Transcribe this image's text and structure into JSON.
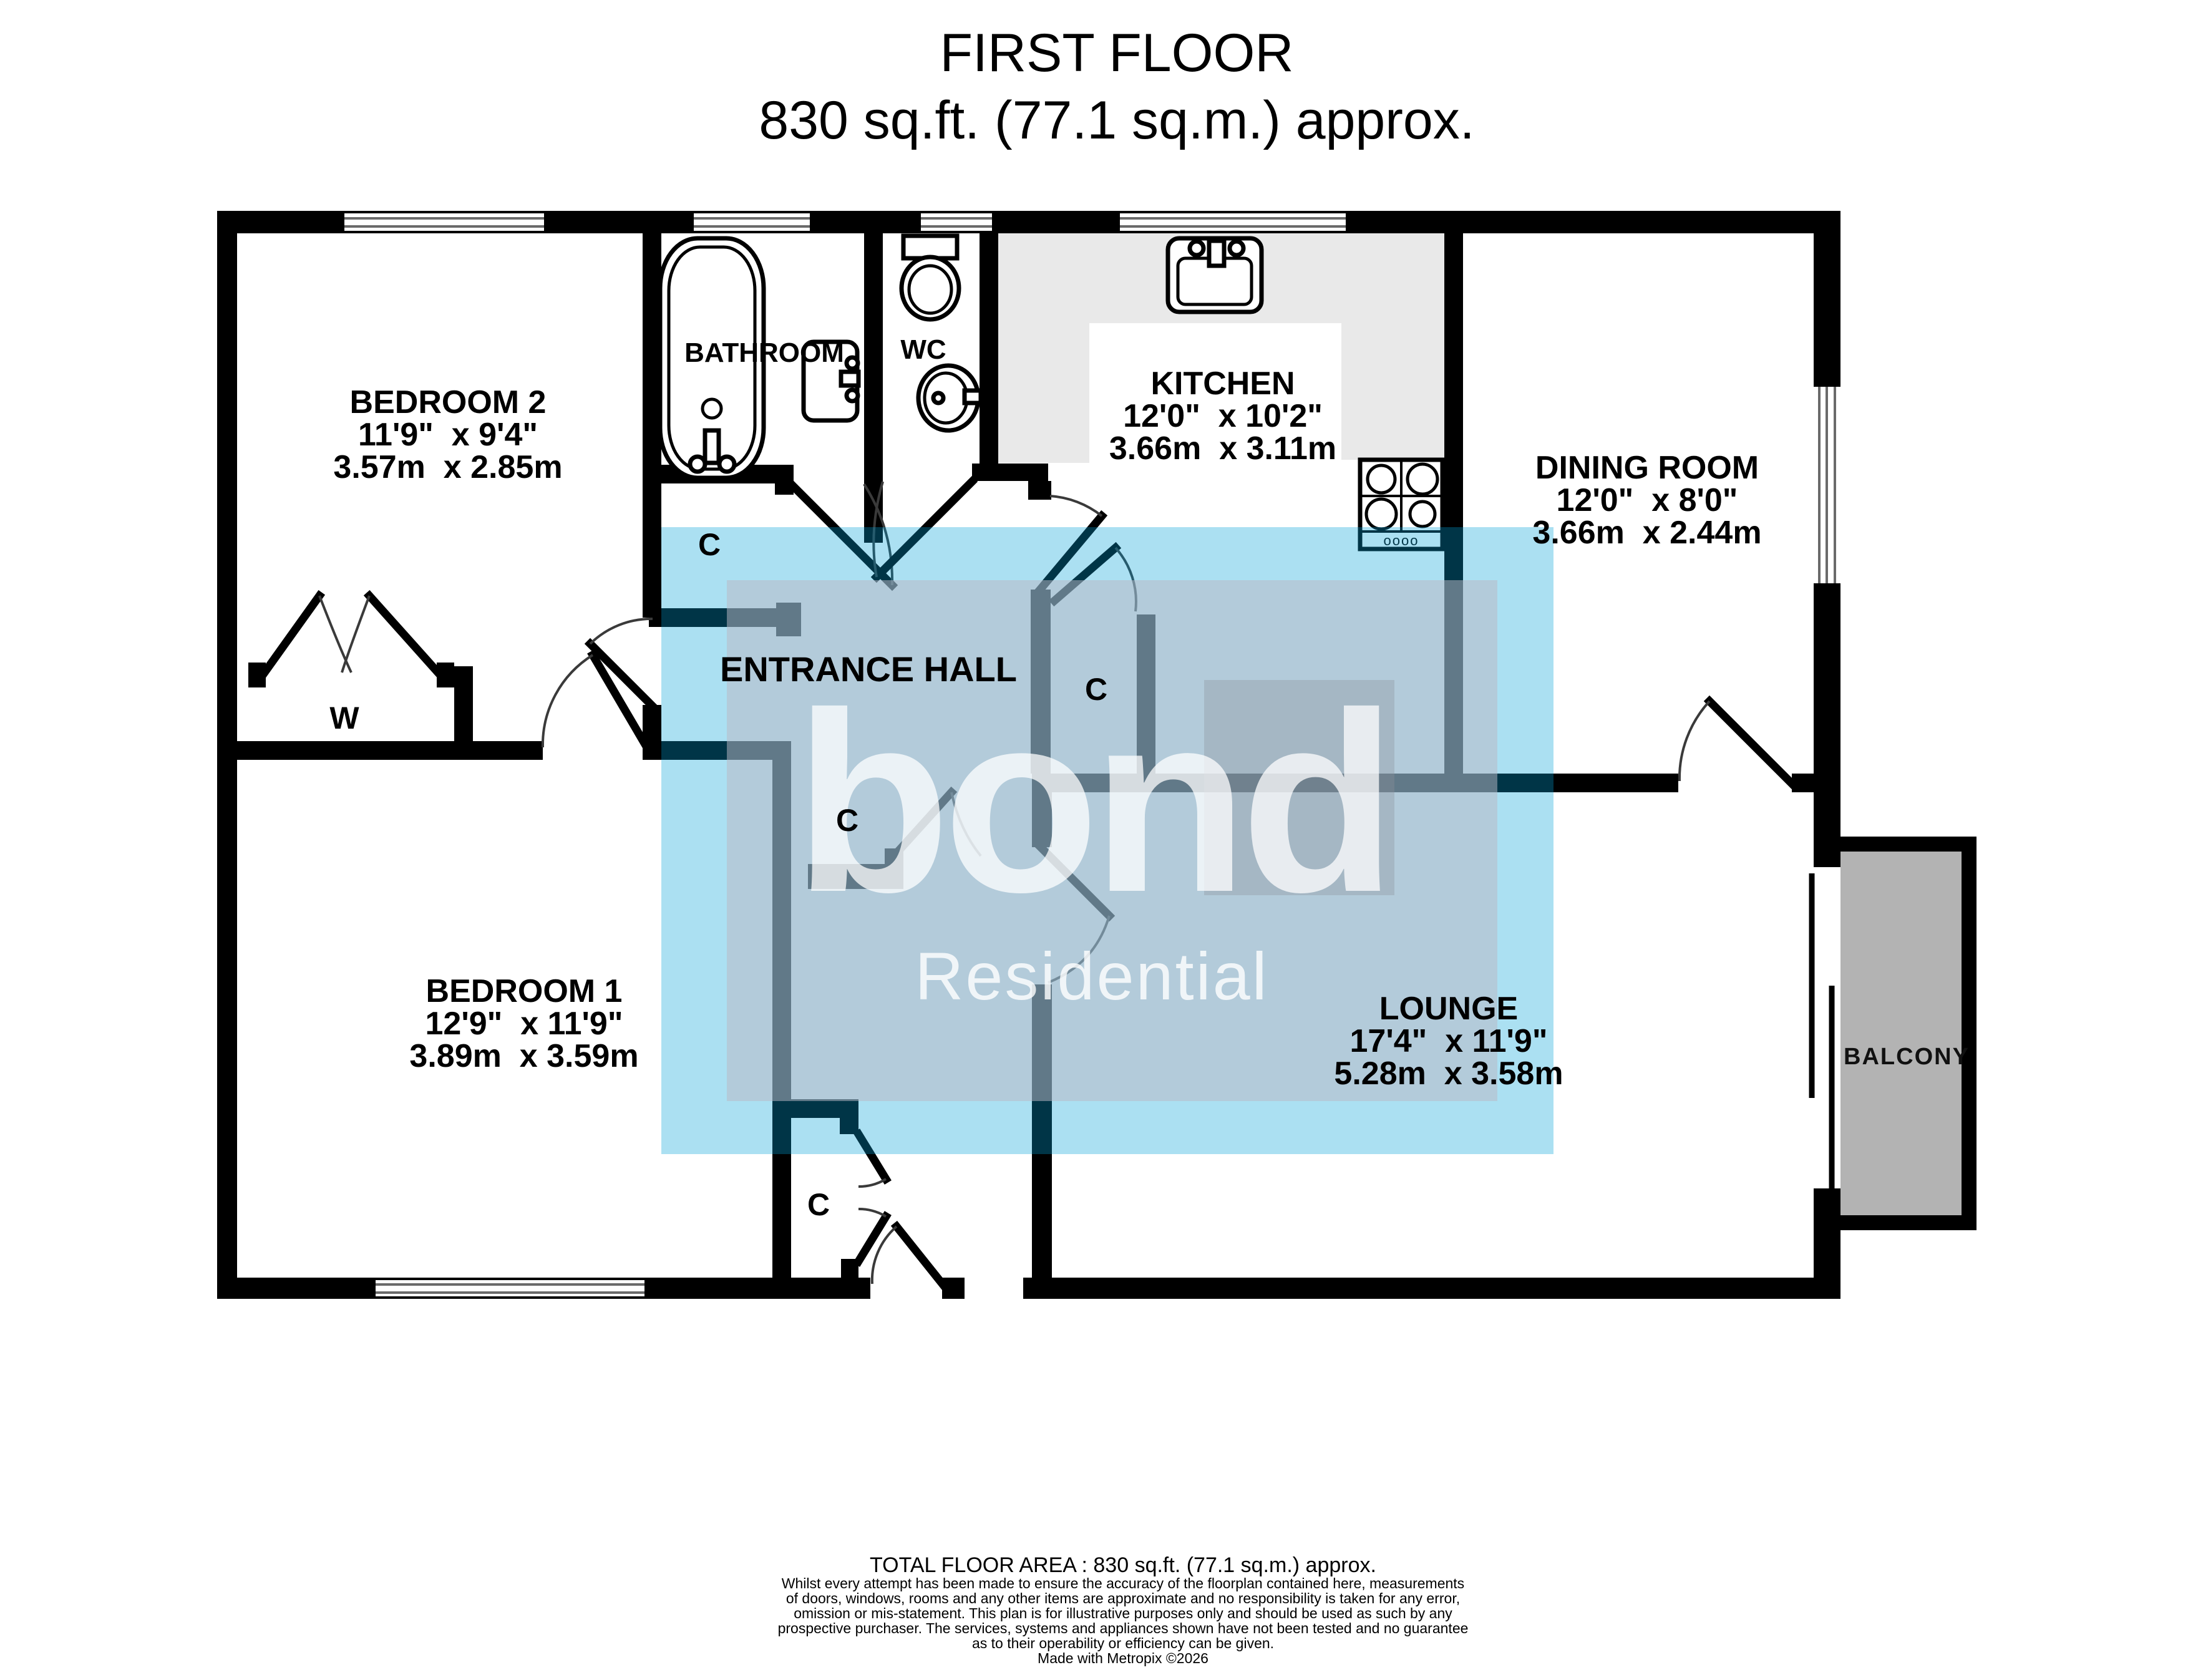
{
  "title": {
    "line1": "FIRST FLOOR",
    "line2": "830 sq.ft. (77.1 sq.m.) approx."
  },
  "watermark": {
    "brand": "bond",
    "subtitle": "Residential"
  },
  "rooms": {
    "bedroom2": {
      "name": "BEDROOM 2",
      "imperial": "11'9\"  x 9'4\"",
      "metric": "3.57m  x 2.85m"
    },
    "bathroom": {
      "name": "BATHROOM"
    },
    "wc": {
      "name": "WC"
    },
    "kitchen": {
      "name": "KITCHEN",
      "imperial": "12'0\"  x 10'2\"",
      "metric": "3.66m  x 3.11m"
    },
    "dining": {
      "name": "DINING ROOM",
      "imperial": "12'0\"  x 8'0\"",
      "metric": "3.66m  x 2.44m"
    },
    "hall": {
      "name": "ENTRANCE HALL"
    },
    "bedroom1": {
      "name": "BEDROOM 1",
      "imperial": "12'9\"  x 11'9\"",
      "metric": "3.89m  x 3.59m"
    },
    "lounge": {
      "name": "LOUNGE",
      "imperial": "17'4\"  x 11'9\"",
      "metric": "5.28m  x 3.58m"
    },
    "balcony": {
      "name": "BALCONY"
    }
  },
  "labels": {
    "closet": "C",
    "wardrobe": "W",
    "hob_knobs": "oooo"
  },
  "footer": {
    "total": "TOTAL FLOOR AREA : 830 sq.ft. (77.1 sq.m.) approx.",
    "disclaimer": [
      "Whilst every attempt has been made to ensure the accuracy of the floorplan contained here, measurements",
      "of doors, windows, rooms and any other items are approximate and no responsibility is taken for any error,",
      "omission or mis-statement. This plan is for illustrative purposes only and should be used as such by any",
      "prospective purchaser. The services, systems and appliances shown have not been tested and no guarantee",
      "as to their operability or efficiency can be given."
    ],
    "credit": "Made with Metropix ©2026"
  },
  "colors": {
    "wall": "#000000",
    "kitchen_counter": "#e9e9e9",
    "balcony_floor": "#b3b3b3",
    "watermark_blue": "#ade1f5",
    "watermark_gray": "#b4bfcc",
    "watermark_dark": "#a8b4c2",
    "watermark_text": "#f2f5f7"
  }
}
